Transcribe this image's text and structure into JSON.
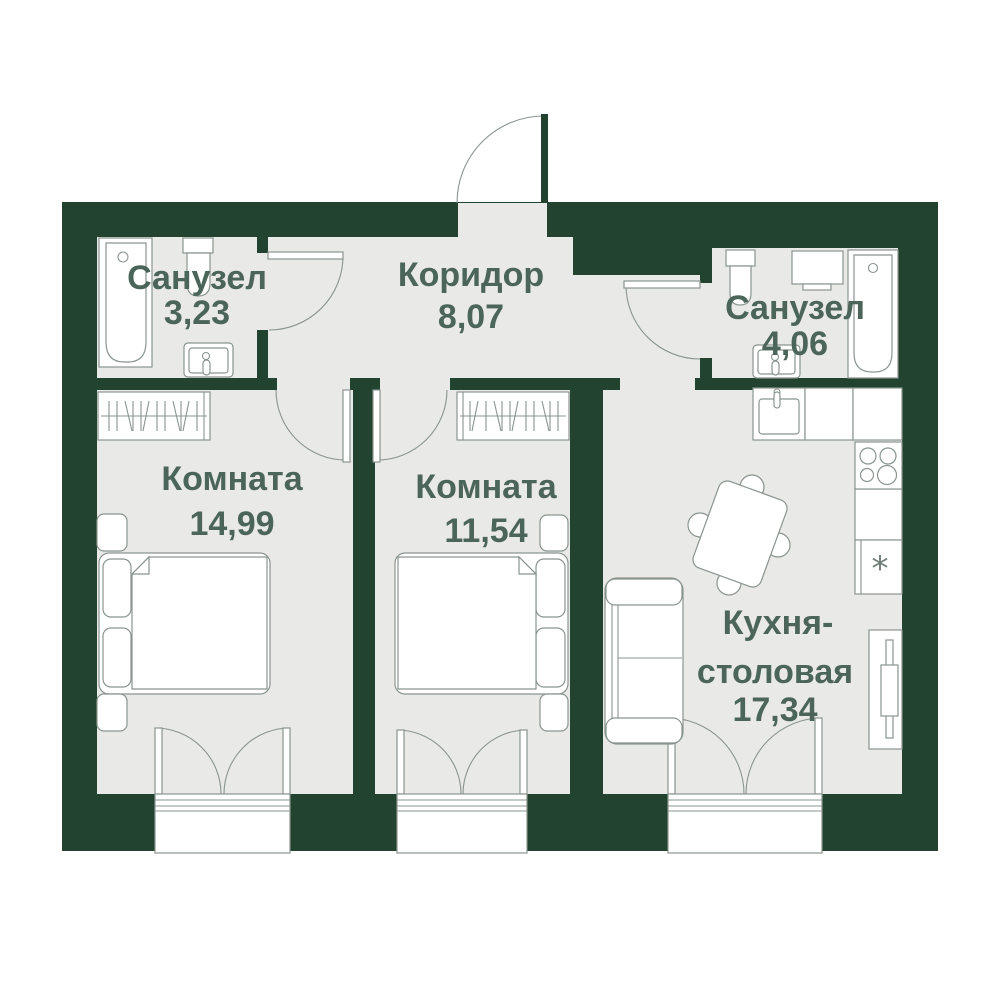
{
  "colors": {
    "wall": "#21432f",
    "floor": "#e9e9e7",
    "outline": "#8a948f",
    "label": "#4b655b"
  },
  "rooms": [
    {
      "name": "Санузел",
      "area": "3,23"
    },
    {
      "name": "Коридор",
      "area": "8,07"
    },
    {
      "name": "Санузел",
      "area": "4,06"
    },
    {
      "name": "Комната",
      "area": "14,99"
    },
    {
      "name": "Комната",
      "area": "11,54"
    },
    {
      "name_line1": "Кухня-",
      "name_line2": "столовая",
      "area": "17,34"
    }
  ],
  "kitchen_fridge_mark": "*"
}
